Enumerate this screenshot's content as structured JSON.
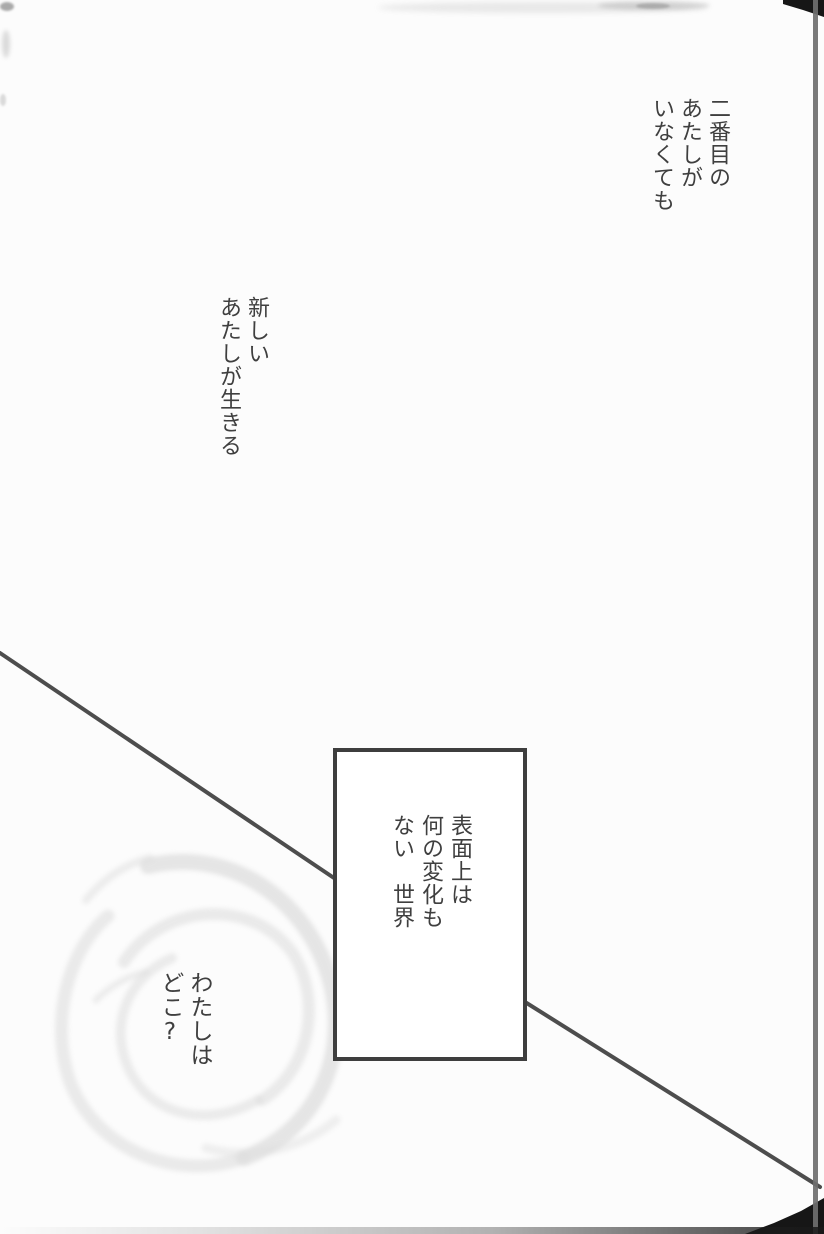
{
  "colors": {
    "page_bg": "#fcfcfc",
    "ink": "#3f3f3f",
    "line": "#4d4d4d",
    "box_border": "#3e3e3e",
    "edge_black": "#161616",
    "edge_gray": "#6f6f6f",
    "swirl": "#c9c9c9"
  },
  "texts": {
    "top_right": {
      "lines": [
        "二番目の",
        "あたしが",
        "いなくても"
      ]
    },
    "new_self": {
      "lines": [
        "新しい",
        "あたしが生きる"
      ]
    },
    "box_caption": {
      "lines": [
        "表面上は",
        "何の変化も",
        "ない　世界"
      ]
    },
    "where": {
      "lines": [
        "わたしは",
        "どこ?"
      ]
    }
  }
}
